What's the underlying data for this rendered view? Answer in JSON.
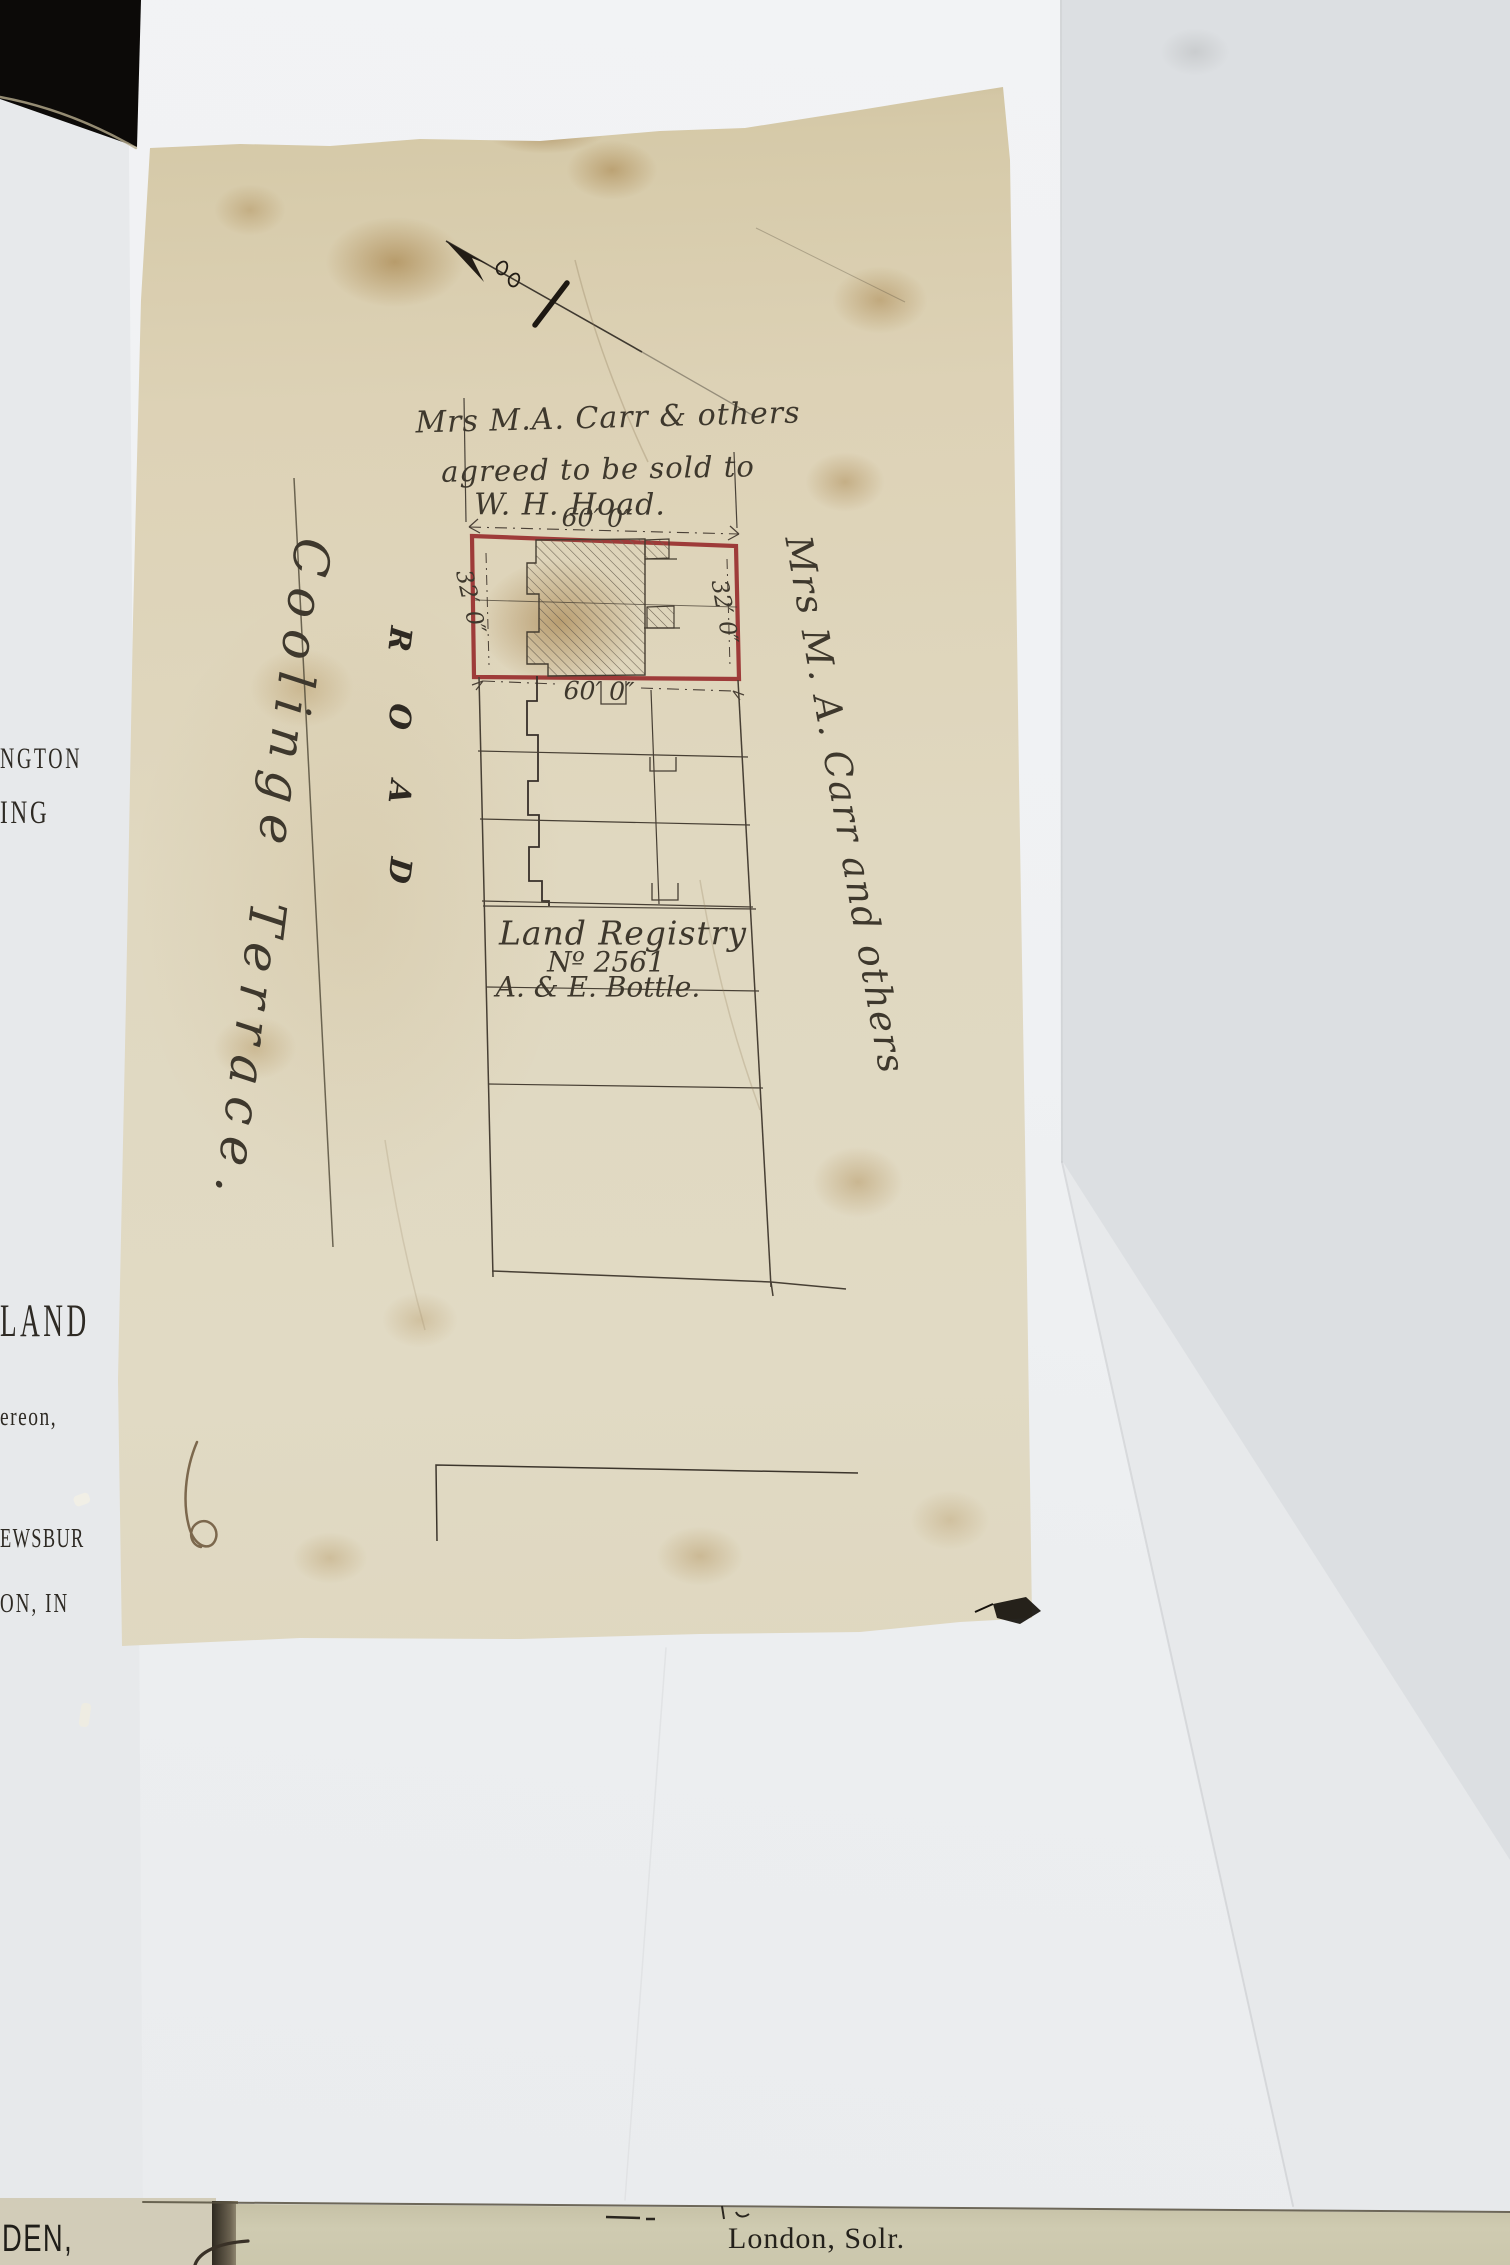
{
  "plan": {
    "title_line1": "Mrs M.A. Carr & others",
    "title_line2": "agreed to be sold to",
    "title_line3": "W. H. Hoad.",
    "dim_top": "60′ 0″",
    "dim_bottom": "60′ 0″",
    "dim_left": "32′ 0″",
    "dim_right": "32′ 0″",
    "road_letters": [
      "R",
      "O",
      "A",
      "D"
    ],
    "terrace_word1": "Coolinge",
    "terrace_word2": "Terrace.",
    "right_owner_label": "Mrs M. A. Carr and others",
    "registry_line1": "Land Registry",
    "registry_line2": "Nº 2561",
    "registry_line3": "A. & E. Bottle."
  },
  "book_edge": {
    "fragments": [
      "NGTON",
      "ING",
      "LAND",
      "ereon,",
      "EWSBUR",
      "ON, IN",
      "DEN,"
    ]
  },
  "slip": {
    "label": "London, Solr."
  },
  "colors": {
    "plot_outline_red": "#9a3331",
    "linen": "#ded5bd",
    "backing_sheet": "#f0f2f4",
    "book_page_tan": "#d5cfbb",
    "slip_tan": "#cdc9af",
    "ink": "#463e33",
    "black_corner": "#0c0a08"
  }
}
